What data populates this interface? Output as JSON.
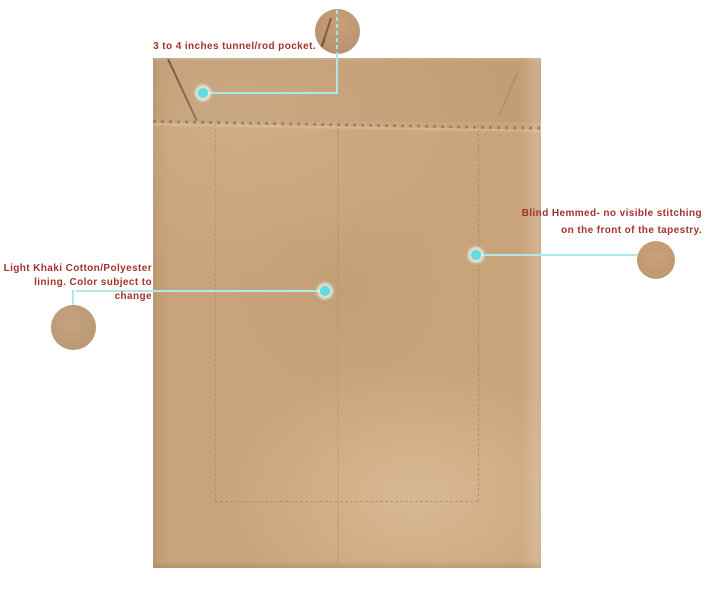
{
  "callouts": {
    "rod_pocket": {
      "label": "3 to 4 inches tunnel/rod pocket."
    },
    "lining": {
      "line1": "Light Khaki Cotton/Polyester",
      "line2": "lining. Color subject to change"
    },
    "blind_hem": {
      "line1": "Blind Hemmed- no visible stitching",
      "line2": "on the front of the tapestry."
    }
  },
  "colors": {
    "background": "#ffffff",
    "label_text": "#a2342c",
    "callout_line": "#ace9e8",
    "callout_dot": "#60dbdf",
    "fabric_base": "#c9a379",
    "seam_stitch": "#8c6d4b"
  }
}
